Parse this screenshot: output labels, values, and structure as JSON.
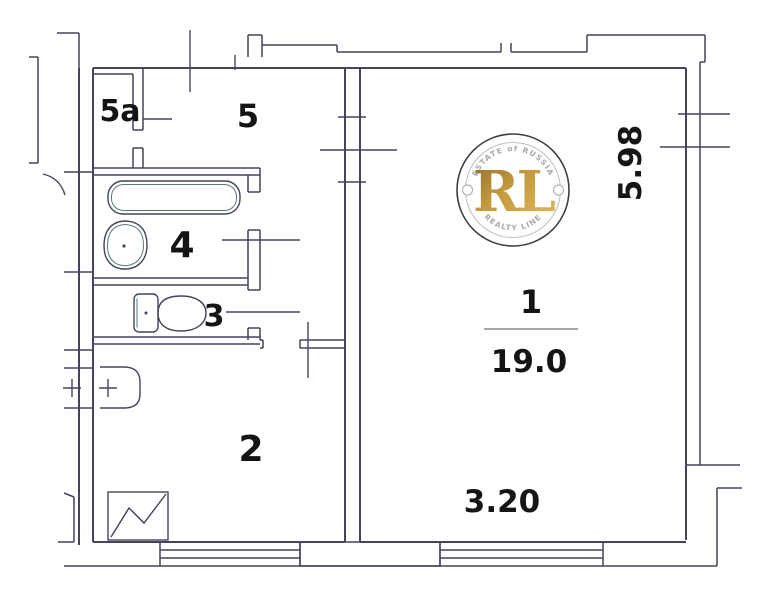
{
  "plan": {
    "title": "apartment-floor-plan",
    "rooms": {
      "r1": {
        "label": "1",
        "area": "19.0"
      },
      "r2": {
        "label": "2"
      },
      "r3": {
        "label": "3"
      },
      "r4": {
        "label": "4"
      },
      "r5": {
        "label": "5"
      },
      "r5a": {
        "label": "5a"
      }
    },
    "dimensions": {
      "room1_width": "3.20",
      "room1_height": "5.98"
    },
    "fixtures": [
      "bathtub-icon",
      "washbasin-icon",
      "toilet-icon",
      "kitchen-sink-icon",
      "stove-icon"
    ],
    "colors": {
      "line": "#44445e",
      "label": "#141414",
      "watermark_gold": "#c09a40",
      "watermark_gray": "#a9a9a9"
    },
    "watermark": {
      "top_text": "ESTATE of RUSSIA",
      "monogram": "RL",
      "bottom_text": "REALTY LINE"
    }
  }
}
